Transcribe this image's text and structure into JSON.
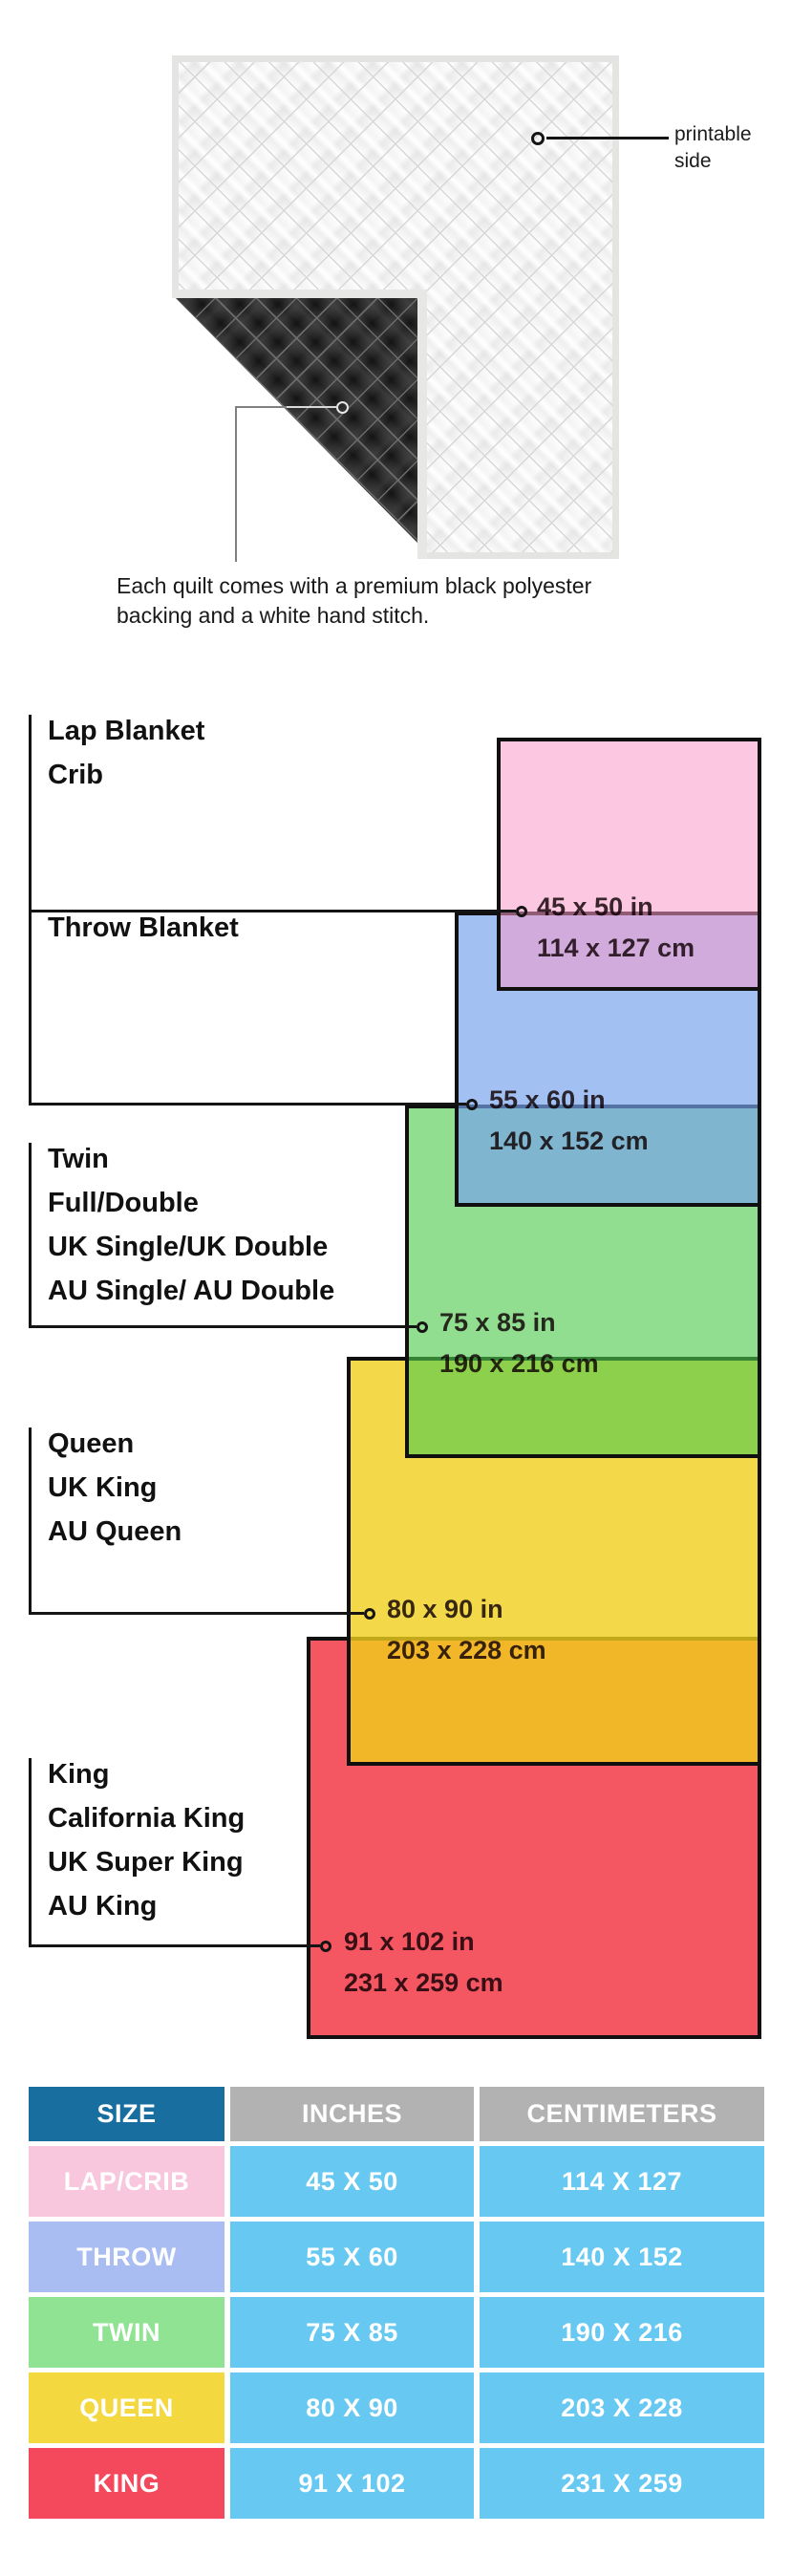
{
  "figure": {
    "printable_side": {
      "line1": "printable",
      "line2": "side"
    },
    "caption": {
      "line1": "Each quilt comes with a premium black polyester",
      "line2": "backing and a white hand stitch."
    },
    "front_color": "#fafafa",
    "backing_color": "#131313"
  },
  "diagram": {
    "sections": [
      {
        "key": "lap",
        "label_lines": [
          "Lap Blanket",
          "Crib"
        ],
        "inches": "45 x 50 in",
        "centimeters": "114 x 127 cm",
        "color": "#FACBE1"
      },
      {
        "key": "throw",
        "label_lines": [
          "Throw Blanket"
        ],
        "inches": "55 x 60 in",
        "centimeters": "140 x 152 cm",
        "color": "#9FC0F1"
      },
      {
        "key": "twin",
        "label_lines": [
          "Twin",
          "Full/Double",
          "UK Single/UK Double",
          "AU Single/ AU Double"
        ],
        "inches": "75 x 85 in",
        "centimeters": "190 x 216 cm",
        "color": "#91E091"
      },
      {
        "key": "queen",
        "label_lines": [
          "Queen",
          "UK King",
          "AU Queen"
        ],
        "inches": "80 x 90 in",
        "centimeters": "203 x 228 cm",
        "color": "#F3D94A"
      },
      {
        "key": "king",
        "label_lines": [
          "King",
          "California King",
          "UK Super King",
          "AU King"
        ],
        "inches": "91 x 102 in",
        "centimeters": "231 x 259 cm",
        "color": "#F34E5D"
      }
    ]
  },
  "table": {
    "headers": [
      "SIZE",
      "INCHES",
      "CENTIMETERS"
    ],
    "header_size_color": "#186F9F",
    "header_gray_color": "#B2B2B2",
    "value_cell_color": "#67C9F2",
    "rows": [
      {
        "size": "LAP/CRIB",
        "inches": "45 X 50",
        "centimeters": "114 X 127",
        "color": "#F9C7DD"
      },
      {
        "size": "THROW",
        "inches": "55 X 60",
        "centimeters": "140 X 152",
        "color": "#A9BDF2"
      },
      {
        "size": "TWIN",
        "inches": "75 X 85",
        "centimeters": "190 X 216",
        "color": "#90E393"
      },
      {
        "size": "QUEEN",
        "inches": "80 X 90",
        "centimeters": "203 X 228",
        "color": "#F4D83F"
      },
      {
        "size": "KING",
        "inches": "91 X 102",
        "centimeters": "231 X 259",
        "color": "#F4495C"
      }
    ]
  }
}
